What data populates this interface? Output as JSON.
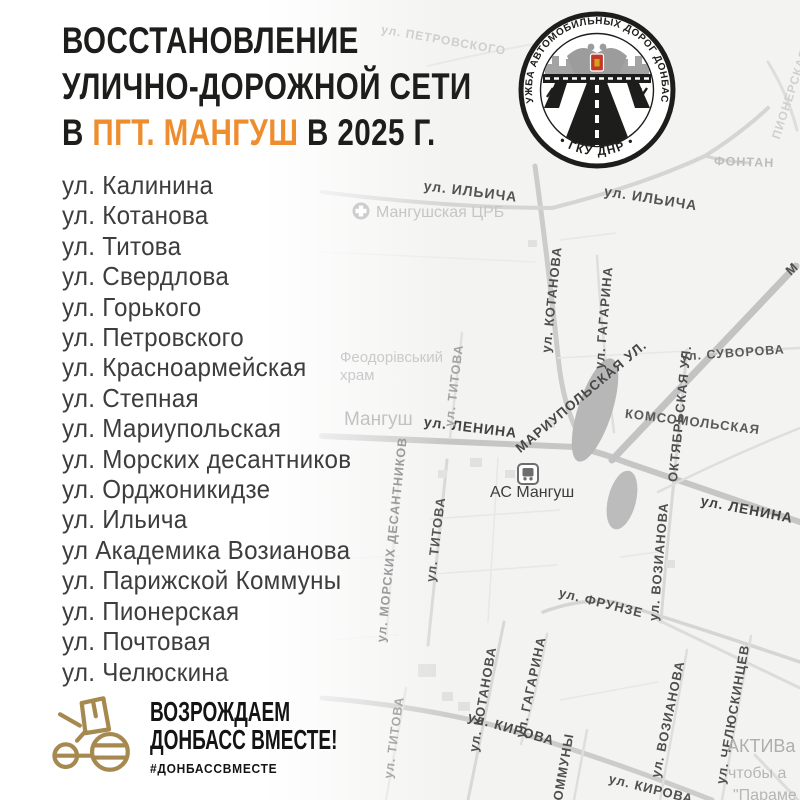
{
  "title": {
    "line1": "ВОССТАНОВЛЕНИЕ",
    "line2": "УЛИЧНО-ДОРОЖНОЙ СЕТИ",
    "line3_prefix": "В ",
    "line3_highlight": "ПГТ. МАНГУШ",
    "line3_suffix": " В 2025 Г."
  },
  "colors": {
    "accent_orange": "#EE8D2E",
    "ink_black": "#1D1D1B",
    "footer_gold": "#A6894E",
    "emblem_shield_red": "#C0392B",
    "map_road_gray": "#C9C9C9"
  },
  "streets": [
    "ул. Калинина",
    "ул. Котанова",
    "ул. Титова",
    "ул. Свердлова",
    "ул. Горького",
    "ул. Петровского",
    "ул. Красноармейская",
    "ул. Степная",
    "ул. Мариупольская",
    "ул. Морских десантников",
    "ул. Орджоникидзе",
    "ул. Ильича",
    "ул Академика Возианова",
    "ул. Парижской Коммуны",
    "ул. Пионерская",
    "ул. Почтовая",
    "ул. Челюскина"
  ],
  "emblem": {
    "ring_top": "СЛУЖБА АВТОМОБИЛЬНЫХ ДОРОГ ДОНБАССА",
    "ring_bottom": "• ГКУ ДНР •",
    "icon": "roads-service-emblem"
  },
  "footer": {
    "line1": "ВОЗРОЖДАЕМ",
    "line2": "ДОНБАСС ВМЕСТЕ!",
    "hashtag": "#ДОНБАССВМЕСТЕ",
    "icon": "road-roller-icon"
  },
  "map": {
    "poi": {
      "town": "Мангуш",
      "hospital": "Мангушская ЦРБ",
      "church_line1": "Феодорівський",
      "church_line2": "храм",
      "bus_station": "АС Мангуш"
    },
    "street_labels": {
      "petrovskogo": "ул. ПЕТРОВСКОГО",
      "pionerskaya": "ПИОНЕРСКАЯ",
      "fontannaya": "ФОНТАН",
      "ilyicha_west": "ул. ИЛЬИЧА",
      "ilyicha_east": "ул. ИЛЬИЧА",
      "kotanova_north": "ул. КОТАНОВА",
      "gagarina_north": "ул. ГАГАРИНА",
      "suvorova": "ул. СУВОРОВА",
      "mariupolskaya": "МАРИУПОЛЬСКАЯ УЛ.",
      "oktyabrskaya": "ОКТЯБРЬСКАЯ УЛ.",
      "komsomolskaya": "КОМСОМОЛЬСКАЯ",
      "lenina_center": "ул. ЛЕНИНА",
      "lenina_east": "ул. ЛЕНИНА",
      "morskih_desantnikov": "ул. МОРСКИХ ДЕСАНТНИКОВ",
      "titova_north": "ул. ТИТОВА",
      "titova_center": "ул. ТИТОВА",
      "titova_south": "ул. ТИТОВА",
      "vozianova_center": "ул. ВОЗИАНОВА",
      "frunze": "ул. ФРУНЗЕ",
      "kotanova_south": "ул. КОТАНОВА",
      "gagarina_south": "ул. ГАГАРИНА",
      "kirova": "ул. КИРОВА",
      "kommuny": "КОММУНЫ",
      "vozianova_south": "ул. ВОЗИАНОВА",
      "chelyuskintsev": "ул. ЧЕЛЮСКИНЦЕВ",
      "kirova_southeast": "ул. КИРОВА",
      "mariupol_edge": "М"
    },
    "edge_text": {
      "line1": "АКТИВа",
      "line2": "чтобы а",
      "line3": "\"Параме"
    }
  }
}
